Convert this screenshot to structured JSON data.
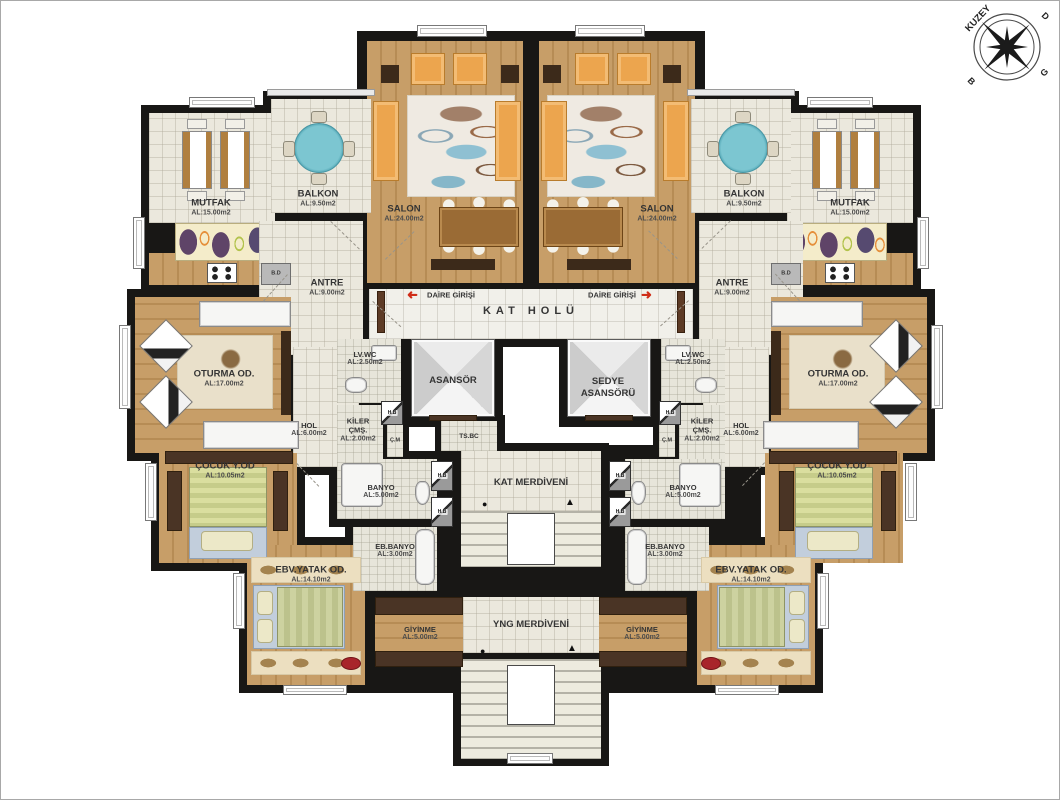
{
  "compass": {
    "north": "KUZEY",
    "east": "D",
    "south": "G",
    "west": "B"
  },
  "corridor": {
    "kat_holu": "KAT HOLÜ",
    "daire_girisi_left": "DAİRE GİRİŞİ",
    "daire_girisi_right": "DAİRE GİRİŞİ"
  },
  "core": {
    "asansor": "ASANSÖR",
    "sedye_line1": "SEDYE",
    "sedye_line2": "ASANSÖRÜ",
    "ts_bc": "TS.BC",
    "kat_merdiveni": "KAT MERDİVENİ",
    "yng_merdiveni": "YNG MERDİVENİ"
  },
  "left": {
    "mutfak": {
      "name": "MUTFAK",
      "area": "AL:15.00m2"
    },
    "balkon": {
      "name": "BALKON",
      "area": "AL:9.50m2"
    },
    "salon": {
      "name": "SALON",
      "area": "AL:24.00m2"
    },
    "antre": {
      "name": "ANTRE",
      "area": "AL:9.00m2"
    },
    "oturma": {
      "name": "OTURMA OD.",
      "area": "AL:17.00m2"
    },
    "hol": {
      "name": "HOL",
      "area": "AL:6.00m2"
    },
    "lvwc": {
      "name": "LV.WC",
      "area": "AL:2.50m2"
    },
    "kiler": {
      "name1": "KİLER",
      "name2": "ÇMŞ.",
      "area": "AL:2.00m2"
    },
    "cm": "Ç.M",
    "banyo": {
      "name": "BANYO",
      "area": "AL:5.00m2"
    },
    "ebbanyo": {
      "name": "EB.BANYO",
      "area": "AL:3.00m2"
    },
    "cocuk": {
      "name": "ÇOCUK Y.OD",
      "area": "AL:10.05m2"
    },
    "ebv": {
      "name": "EBV.YATAK OD.",
      "area": "AL:14.10m2"
    },
    "giyinme": {
      "name": "GİYİNME",
      "area": "AL:5.00m2"
    },
    "bd": "B.D"
  },
  "right": {
    "mutfak": {
      "name": "MUTFAK",
      "area": "AL:15.00m2"
    },
    "balkon": {
      "name": "BALKON",
      "area": "AL:9.50m2"
    },
    "salon": {
      "name": "SALON",
      "area": "AL:24.00m2"
    },
    "antre": {
      "name": "ANTRE",
      "area": "AL:9.00m2"
    },
    "oturma": {
      "name": "OTURMA OD.",
      "area": "AL:17.00m2"
    },
    "hol": {
      "name": "HOL",
      "area": "AL:6.00m2"
    },
    "lvwc": {
      "name": "LV.WC",
      "area": "AL:2.50m2"
    },
    "kiler": {
      "name1": "KİLER",
      "name2": "ÇMŞ.",
      "area": "AL:2.00m2"
    },
    "cm": "Ç.M",
    "banyo": {
      "name": "BANYO",
      "area": "AL:5.00m2"
    },
    "ebbanyo": {
      "name": "EB.BANYO",
      "area": "AL:3.00m2"
    },
    "cocuk": {
      "name": "ÇOCUK Y.OD",
      "area": "AL:10.05m2"
    },
    "ebv": {
      "name": "EBV.YATAK OD.",
      "area": "AL:14.10m2"
    },
    "giyinme": {
      "name": "GİYİNME",
      "area": "AL:5.00m2"
    },
    "bd": "B.D"
  },
  "misc": {
    "hb": "H.B"
  }
}
